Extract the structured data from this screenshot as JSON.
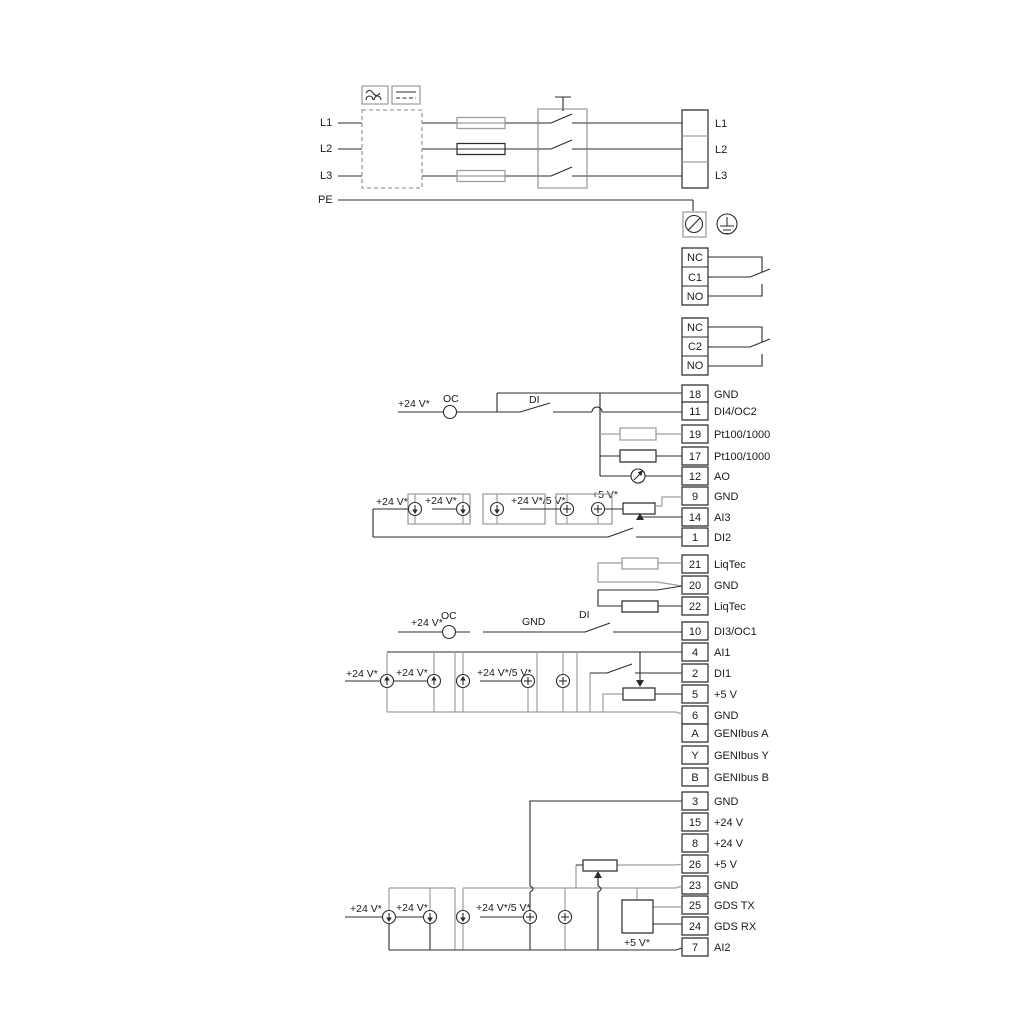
{
  "diagram": {
    "colors": {
      "line": "#2b2b2b",
      "alt": "#9d9d9d"
    },
    "left_labels": {
      "l1": "L1",
      "l2": "L2",
      "l3": "L3",
      "pe": "PE"
    },
    "mains_block": {
      "l1": "L1",
      "l2": "L2",
      "l3": "L3"
    },
    "relay1": {
      "nc": "NC",
      "c": "C1",
      "no": "NO"
    },
    "relay2": {
      "nc": "NC",
      "c": "C2",
      "no": "NO"
    },
    "terminals": [
      {
        "pin": "18",
        "label": "GND"
      },
      {
        "pin": "11",
        "label": "DI4/OC2"
      },
      {
        "pin": "19",
        "label": "Pt100/1000"
      },
      {
        "pin": "17",
        "label": "Pt100/1000"
      },
      {
        "pin": "12",
        "label": "AO"
      },
      {
        "pin": "9",
        "label": "GND"
      },
      {
        "pin": "14",
        "label": "AI3"
      },
      {
        "pin": "1",
        "label": "DI2"
      },
      {
        "pin": "21",
        "label": "LiqTec"
      },
      {
        "pin": "20",
        "label": "GND"
      },
      {
        "pin": "22",
        "label": "LiqTec"
      },
      {
        "pin": "10",
        "label": "DI3/OC1"
      },
      {
        "pin": "4",
        "label": "AI1"
      },
      {
        "pin": "2",
        "label": "DI1"
      },
      {
        "pin": "5",
        "label": "+5 V"
      },
      {
        "pin": "6",
        "label": "GND"
      },
      {
        "pin": "A",
        "label": "GENIbus A"
      },
      {
        "pin": "Y",
        "label": "GENIbus Y"
      },
      {
        "pin": "B",
        "label": "GENIbus B"
      },
      {
        "pin": "3",
        "label": "GND"
      },
      {
        "pin": "15",
        "label": "+24 V"
      },
      {
        "pin": "8",
        "label": "+24 V"
      },
      {
        "pin": "26",
        "label": "+5 V"
      },
      {
        "pin": "23",
        "label": "GND"
      },
      {
        "pin": "25",
        "label": "GDS TX"
      },
      {
        "pin": "24",
        "label": "GDS RX"
      },
      {
        "pin": "7",
        "label": "AI2"
      }
    ],
    "notes": {
      "di4_v24": "+24 V*",
      "di4_oc": "OC",
      "di4_di": "DI",
      "ai3_v24_a": "+24 V*",
      "ai3_v24_b": "+24 V*",
      "ai3_v24_5v": "+24 V*/5 V*",
      "ai3_v5": "+5 V*",
      "di3_v24": "+24 V*",
      "di3_oc": "OC",
      "di3_gnd": "GND",
      "di3_di": "DI",
      "ai1_v24_a": "+24 V*",
      "ai1_v24_b": "+24 V*",
      "ai1_v24_5v": "+24 V*/5 V*",
      "ai2_v24_a": "+24 V*",
      "ai2_v24_b": "+24 V*",
      "ai2_v24_5v": "+24 V*/5 V*",
      "gds_v5": "+5 V*"
    }
  }
}
